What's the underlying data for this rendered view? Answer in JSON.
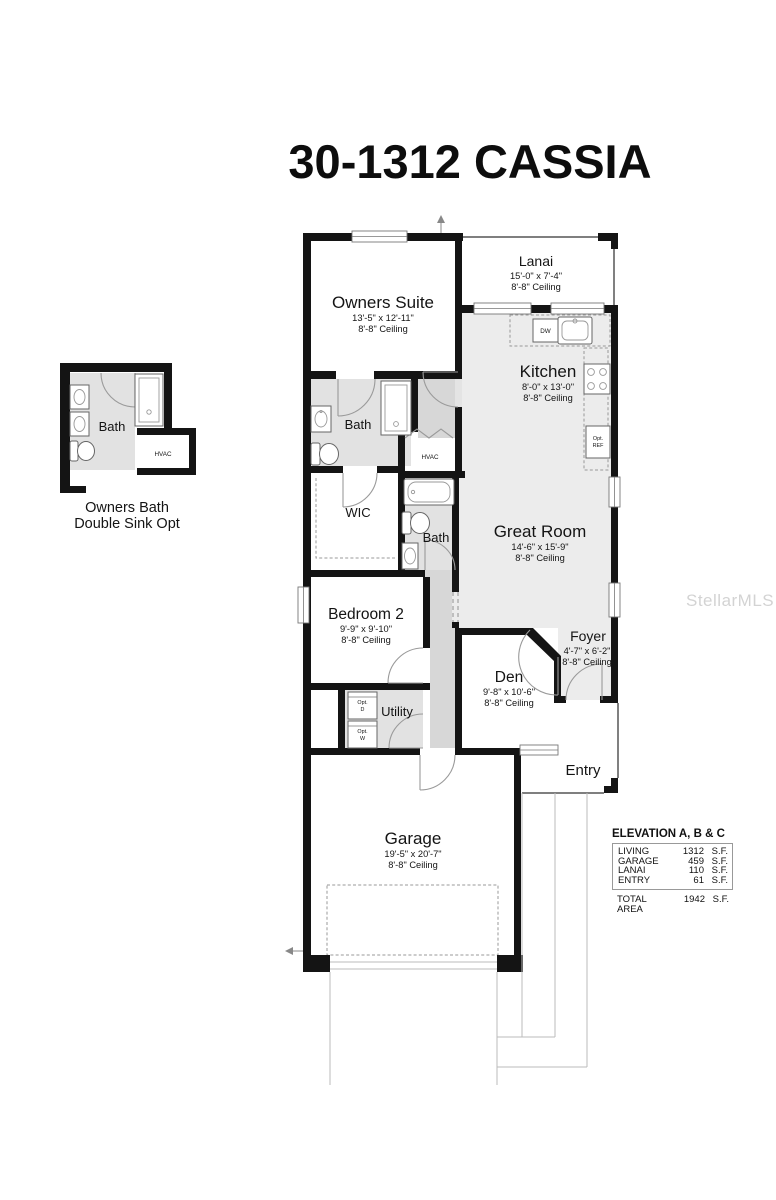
{
  "title": "30-1312 CASSIA",
  "watermark": "StellarMLS",
  "rooms": {
    "owners_suite": {
      "name": "Owners Suite",
      "dims": "13'-5\" x 12'-11\"",
      "ceiling": "8'-8\" Ceiling"
    },
    "lanai": {
      "name": "Lanai",
      "dims": "15'-0\" x 7'-4\"",
      "ceiling": "8'-8\" Ceiling"
    },
    "kitchen": {
      "name": "Kitchen",
      "dims": "8'-0\" x 13'-0\"",
      "ceiling": "8'-8\" Ceiling"
    },
    "great_room": {
      "name": "Great Room",
      "dims": "14'-6\" x 15'-9\"",
      "ceiling": "8'-8\" Ceiling"
    },
    "bedroom_2": {
      "name": "Bedroom 2",
      "dims": "9'-9\" x 9'-10\"",
      "ceiling": "8'-8\" Ceiling"
    },
    "den": {
      "name": "Den",
      "dims": "9'-8\" x 10'-6\"",
      "ceiling": "8'-8\" Ceiling"
    },
    "foyer": {
      "name": "Foyer",
      "dims": "4'-7\" x 6'-2\"",
      "ceiling": "8'-8\" Ceiling"
    },
    "garage": {
      "name": "Garage",
      "dims": "19'-5\" x 20'-7\"",
      "ceiling": "8'-8\" Ceiling"
    },
    "owners_bath": {
      "name": "Bath"
    },
    "bath_2": {
      "name": "Bath"
    },
    "wic": {
      "name": "WIC"
    },
    "utility": {
      "name": "Utility"
    },
    "entry": {
      "name": "Entry"
    },
    "hvac": {
      "name": "HVAC"
    }
  },
  "fixtures": {
    "dishwasher": "DW",
    "opt_ref": [
      "Opt.",
      "REF"
    ],
    "opt_dryer": [
      "Opt.",
      "D"
    ],
    "opt_washer": [
      "Opt.",
      "W"
    ]
  },
  "inset": {
    "bath_label": "Bath",
    "hvac_label": "HVAC",
    "caption": [
      "Owners Bath",
      "Double Sink Opt"
    ]
  },
  "area_table": {
    "title": "ELEVATION A, B & C",
    "rows": [
      {
        "label": "LIVING",
        "value": "1312",
        "unit": "S.F."
      },
      {
        "label": "GARAGE",
        "value": "459",
        "unit": "S.F."
      },
      {
        "label": "LANAI",
        "value": "110",
        "unit": "S.F."
      },
      {
        "label": "ENTRY",
        "value": "61",
        "unit": "S.F."
      }
    ],
    "total": {
      "label": "TOTAL AREA",
      "value": "1942",
      "unit": "S.F."
    }
  }
}
